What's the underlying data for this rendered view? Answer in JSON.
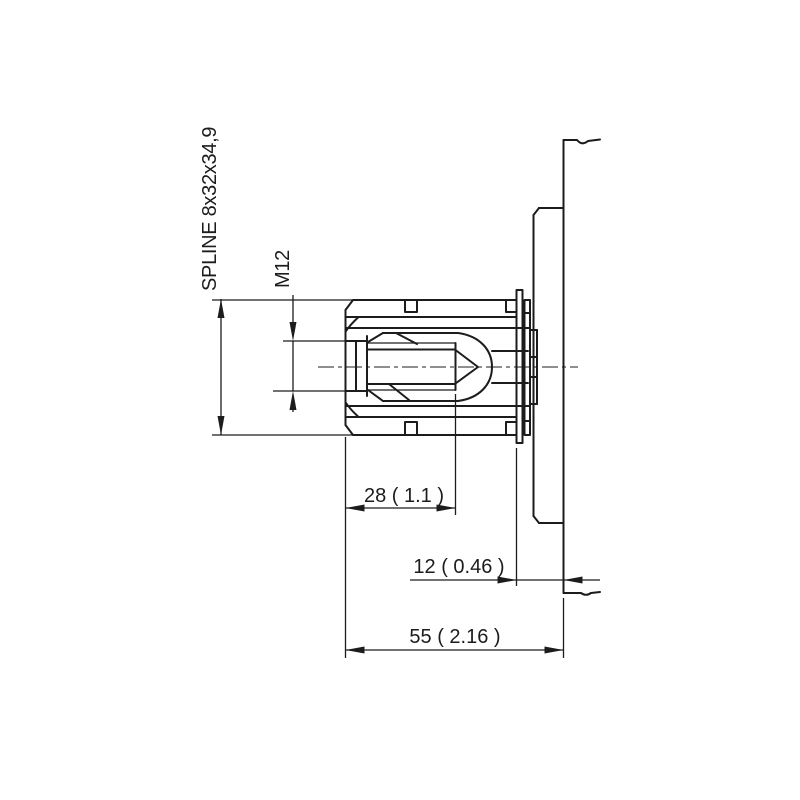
{
  "drawing": {
    "title": "hydraulic-motor-output-shaft-side-view",
    "background_color": "#ffffff",
    "line_color": "#1c1c1c",
    "labels": {
      "spline": "SPLINE 8x32x34,9",
      "thread": "M12",
      "thread_depth": "28 ( 1.1 )",
      "pilot_offset": "12 ( 0.46 )",
      "shaft_length": "55 ( 2.16 )"
    }
  }
}
